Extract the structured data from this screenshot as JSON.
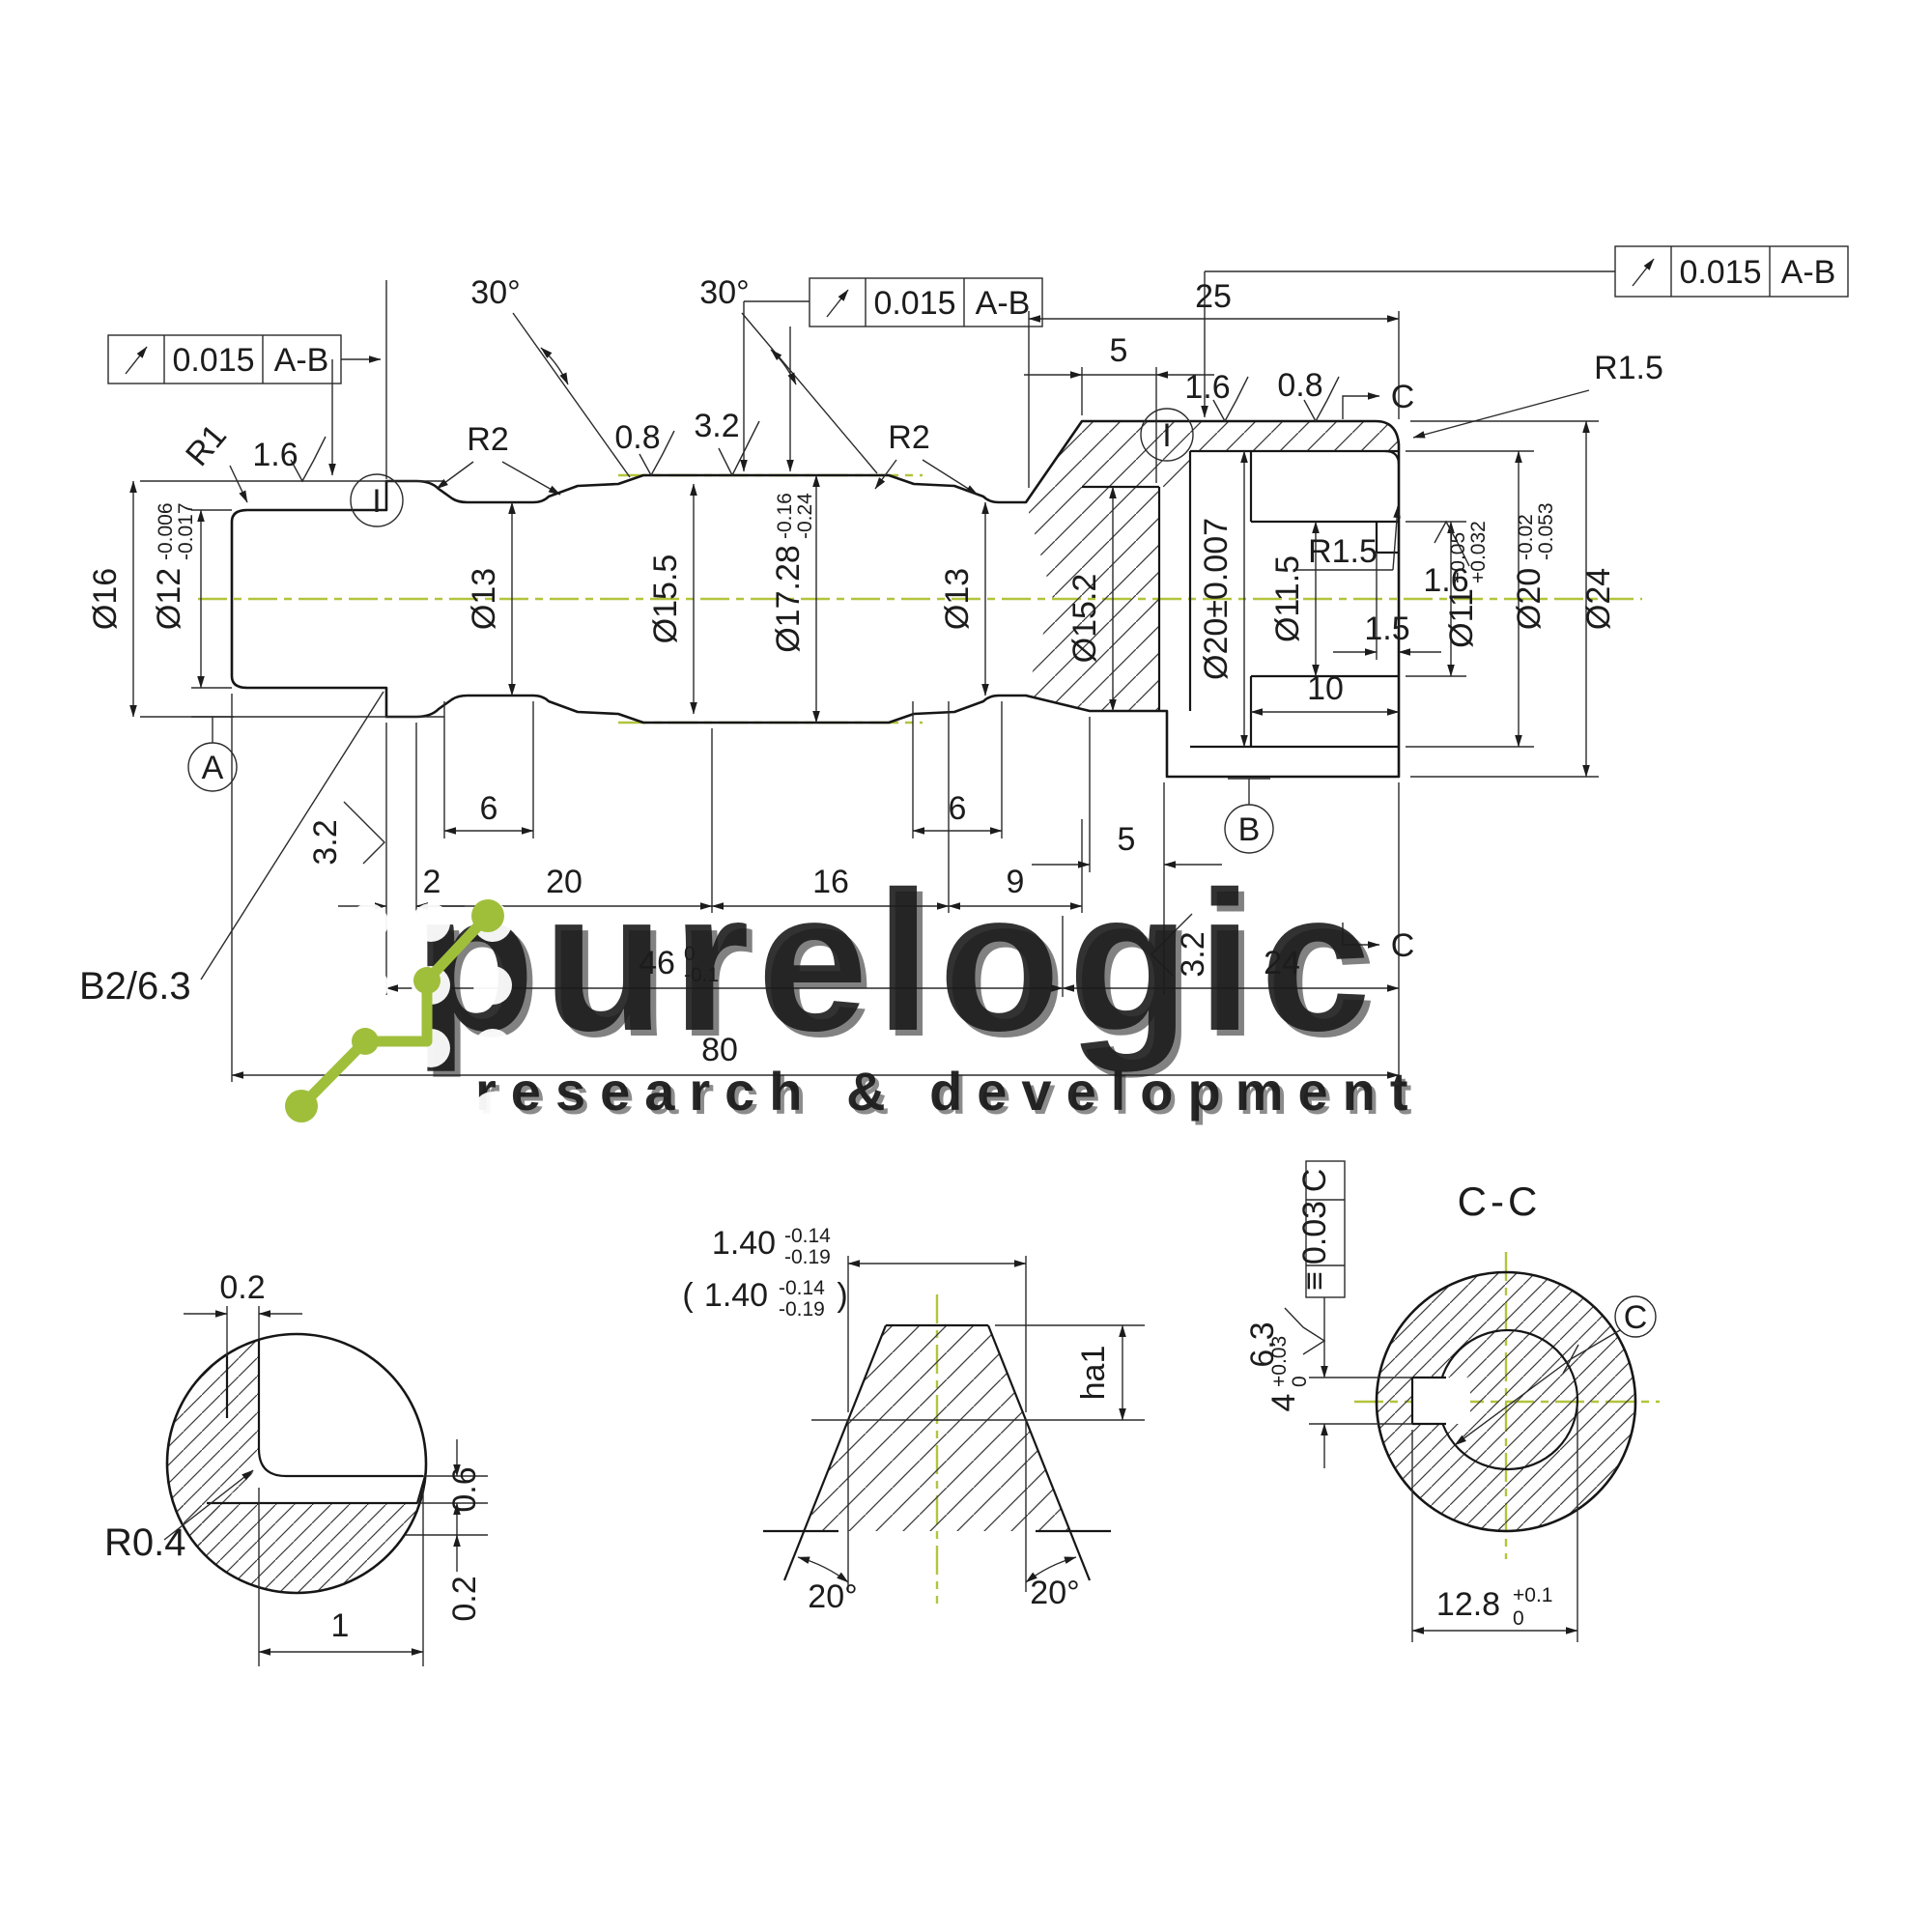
{
  "colors": {
    "line": "#1c1c1c",
    "green_logo": "#9fbf3b",
    "centerline_green": "#b3c43c",
    "watermark": "#ffffff"
  },
  "frames": {
    "f1": {
      "value": "0.015",
      "datum": "A-B"
    },
    "f2": {
      "value": "0.015",
      "datum": "A-B"
    },
    "f3": {
      "value": "0.015",
      "datum": "A-B"
    },
    "fcc": {
      "sym": "≡",
      "value": "0.03",
      "datum": "C"
    }
  },
  "main": {
    "d16": "Ø16",
    "d12": "Ø12",
    "d12a": "-0.006",
    "d12b": "-0.017",
    "d13a": "Ø13",
    "d155": "Ø15.5",
    "d1728": "Ø17.28",
    "d1728a": "-0.16",
    "d1728b": "-0.24",
    "d13b": "Ø13",
    "d152": "Ø15.2",
    "d20m": "Ø20±0.007",
    "d115": "Ø11.5",
    "d11": "Ø11",
    "d11a": "+0.05",
    "d11b": "+0.032",
    "d20r": "Ø20",
    "d20ra": "-0.02",
    "d20rb": "-0.053",
    "d24": "Ø24",
    "r1": "R1",
    "r2a": "R2",
    "r2b": "R2",
    "r15a": "R1.5",
    "r15b": "R1.5",
    "a30a": "30°",
    "a30b": "30°",
    "f16a": "1.6",
    "f08a": "0.8",
    "f32a": "3.2",
    "f16b": "1.6",
    "f08b": "0.8",
    "f16c": "1.6",
    "f32b": "3.2",
    "f32c": "3.2",
    "i1": "I",
    "i2": "I",
    "dA": "A",
    "dB": "B",
    "secC1": "C",
    "secC2": "C",
    "l25": "25",
    "l5t": "5",
    "l2": "2",
    "l20": "20",
    "l16": "16",
    "l9": "9",
    "l6a": "6",
    "l6b": "6",
    "l5b": "5",
    "l46": "46",
    "l46a": "0",
    "l46b": "-0.1",
    "l24": "24",
    "l80": "80",
    "l15": "1.5",
    "l10": "10",
    "note": "B2/6.3"
  },
  "viewA": {
    "t02": "0.2",
    "r06": "0.6",
    "r02": "0.2",
    "b1": "1",
    "r04": "R0.4"
  },
  "viewB": {
    "popen": "(",
    "pclose": ")",
    "d140": "1.40",
    "d140a": "-0.14",
    "d140b": "-0.19",
    "p140": "1.40",
    "p140a": "-0.14",
    "p140b": "-0.19",
    "ha1": "ha1",
    "a20l": "20°",
    "a20r": "20°"
  },
  "viewC": {
    "title": "C-C",
    "f63": "6.3",
    "d4": "4",
    "d4a": "+0.03",
    "d4b": "0",
    "d128": "12.8",
    "d128a": "+0.1",
    "d128b": "0",
    "c": "C"
  },
  "watermark": {
    "word": "purelogic",
    "sub": "research & development"
  }
}
